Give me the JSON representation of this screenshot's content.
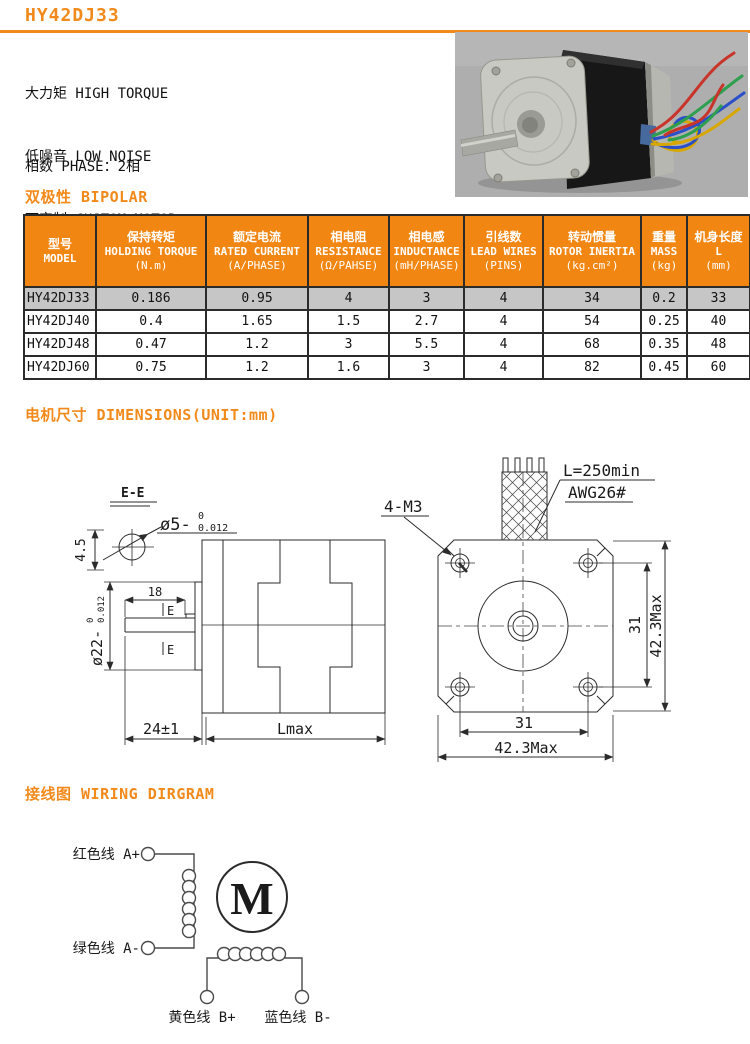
{
  "title": "HY42DJ33",
  "intro": {
    "features": [
      "大力矩 HIGH TORQUE",
      "低噪音 LOW NOISE",
      "可定制 CUSTOM MOTOR"
    ],
    "specs": [
      "相数 PHASE：2相",
      "步距角度 STEP ANGLE：1.8°",
      "机座尺寸 MOTOR FRAME SIZE：42x42mm"
    ]
  },
  "sections": {
    "bipolar": "双极性 BIPOLAR",
    "dimensions": "电机尺寸 DIMENSIONS(UNIT:mm)",
    "wiring": "接线图 WIRING DIRGRAM"
  },
  "spec_table": {
    "headers": [
      {
        "cn": "型号",
        "en": "MODEL",
        "unit": ""
      },
      {
        "cn": "保持转矩",
        "en": "HOLDING TORQUE",
        "unit": "(N.m)"
      },
      {
        "cn": "额定电流",
        "en": "RATED CURRENT",
        "unit": "(A/PHASE)"
      },
      {
        "cn": "相电阻",
        "en": "RESISTANCE",
        "unit": "(Ω/PAHSE)"
      },
      {
        "cn": "相电感",
        "en": "INDUCTANCE",
        "unit": "(mH/PHASE)"
      },
      {
        "cn": "引线数",
        "en": "LEAD WIRES",
        "unit": "(PINS)"
      },
      {
        "cn": "转动惯量",
        "en": "ROTOR INERTIA",
        "unit": "(kg.cm²)"
      },
      {
        "cn": "重量",
        "en": "MASS",
        "unit": "(kg)"
      },
      {
        "cn": "机身长度",
        "en": "L",
        "unit": "(mm)"
      }
    ],
    "rows": [
      [
        "HY42DJ33",
        "0.186",
        "0.95",
        "4",
        "3",
        "4",
        "34",
        "0.2",
        "33"
      ],
      [
        "HY42DJ40",
        "0.4",
        "1.65",
        "1.5",
        "2.7",
        "4",
        "54",
        "0.25",
        "40"
      ],
      [
        "HY42DJ48",
        "0.47",
        "1.2",
        "3",
        "5.5",
        "4",
        "68",
        "0.35",
        "48"
      ],
      [
        "HY42DJ60",
        "0.75",
        "1.2",
        "1.6",
        "3",
        "4",
        "82",
        "0.45",
        "60"
      ]
    ],
    "highlighted_model": "HY42DJ33"
  },
  "drawing": {
    "section_label": "E-E",
    "shaft_dia": "ø5-",
    "shaft_tol_hi": "0",
    "shaft_tol_lo": "0.012",
    "flat_height": "4.5",
    "pilot_dia": "ø22-",
    "pilot_tol_hi": "0",
    "pilot_tol_lo": "0.012",
    "key_len": "18",
    "e_mark": "E",
    "shaft_total": "24±1",
    "body_len": "Lmax",
    "thread": "4-M3",
    "lead_len": "L=250min",
    "lead_gauge": "AWG26#",
    "pitch_v": "31",
    "frame_v": "42.3Max",
    "pitch_h": "31",
    "frame_h": "42.3Max"
  },
  "wiring": {
    "phase_a_plus": "红色线 A+",
    "phase_a_minus": "绿色线 A-",
    "phase_b_plus": "黄色线 B+",
    "phase_b_minus": "蓝色线 B-",
    "motor_symbol": "M"
  },
  "colors": {
    "accent": "#F28A1B",
    "table_header_bg": "#F28612",
    "table_header_text": "#FFFFFF",
    "highlight_row_bg": "#C6C6C6",
    "line": "#2B2B2B",
    "wire_red": "#C8342A",
    "wire_green": "#2E9E4F",
    "wire_blue": "#2B4FC8",
    "wire_yellow": "#D8A800"
  }
}
